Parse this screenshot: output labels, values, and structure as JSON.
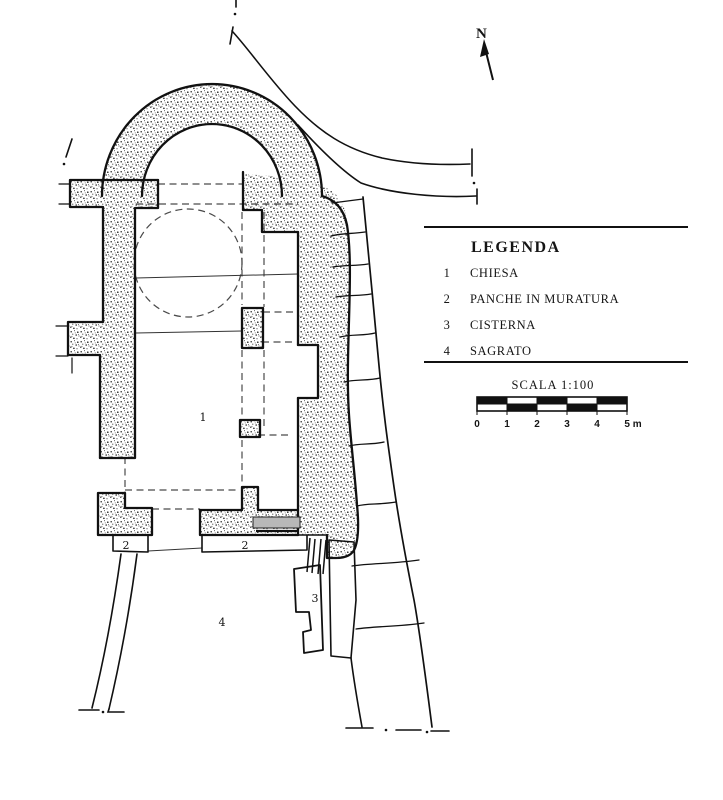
{
  "page": {
    "background": "#ffffff",
    "ink": "#1a1a1a"
  },
  "compass": {
    "label": "N"
  },
  "legend": {
    "title": "LEGENDA",
    "items": [
      {
        "num": "1",
        "label": "CHIESA"
      },
      {
        "num": "2",
        "label": "PANCHE IN MURATURA"
      },
      {
        "num": "3",
        "label": "CISTERNA"
      },
      {
        "num": "4",
        "label": "SAGRATO"
      }
    ]
  },
  "scale": {
    "title": "SCALA 1:100",
    "ticks": [
      "0",
      "1",
      "2",
      "3",
      "4",
      "5 m"
    ]
  },
  "plan": {
    "labels": {
      "chiesa": "1",
      "panche_left": "2",
      "panche_right": "2",
      "cisterna": "3",
      "sagrato": "4"
    },
    "colors": {
      "threshold_gray": "#b8b8b8"
    }
  }
}
